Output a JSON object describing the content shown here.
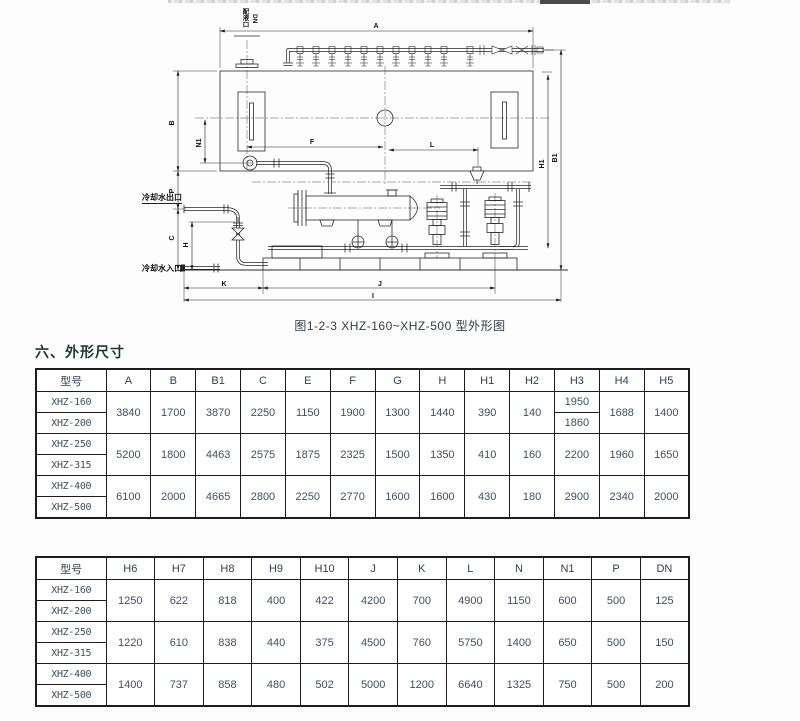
{
  "colors": {
    "line": "#2a2a2a",
    "table_text": "#3b5162",
    "heading_text": "#1f3038"
  },
  "drawing": {
    "caption": "图1-2-3 XHZ-160~XHZ-500 型外形图",
    "labels": {
      "a": "A",
      "b": "B",
      "n1": "N1",
      "f": "F",
      "l": "L",
      "p": "P",
      "c": "C",
      "h": "H",
      "h1": "H1",
      "b1": "B1",
      "k": "K",
      "j": "J",
      "i": "I",
      "port": "配液口",
      "dn": "DN",
      "water_outlet": "冷却水出口",
      "water_inlet": "冷却水入口"
    }
  },
  "section": {
    "heading": "六、外形尺寸"
  },
  "tables": [
    {
      "headers": [
        "型号",
        "A",
        "B",
        "B1",
        "C",
        "E",
        "F",
        "G",
        "H",
        "H1",
        "H2",
        "H3",
        "H4",
        "H5"
      ],
      "rows": [
        [
          {
            "t": "XHZ-160"
          },
          {
            "t": "3840",
            "rs": 2
          },
          {
            "t": "1700",
            "rs": 2
          },
          {
            "t": "3870",
            "rs": 2
          },
          {
            "t": "2250",
            "rs": 2
          },
          {
            "t": "1150",
            "rs": 2
          },
          {
            "t": "1900",
            "rs": 2
          },
          {
            "t": "1300",
            "rs": 2
          },
          {
            "t": "1440",
            "rs": 2
          },
          {
            "t": "390",
            "rs": 2
          },
          {
            "t": "140",
            "rs": 2
          },
          {
            "t": "1950"
          },
          {
            "t": "1688",
            "rs": 2
          },
          {
            "t": "1400",
            "rs": 2
          }
        ],
        [
          {
            "t": "XHZ-200"
          },
          {
            "t": "1860"
          }
        ],
        [
          {
            "t": "XHZ-250"
          },
          {
            "t": "5200",
            "rs": 2
          },
          {
            "t": "1800",
            "rs": 2
          },
          {
            "t": "4463",
            "rs": 2
          },
          {
            "t": "2575",
            "rs": 2
          },
          {
            "t": "1875",
            "rs": 2
          },
          {
            "t": "2325",
            "rs": 2
          },
          {
            "t": "1500",
            "rs": 2
          },
          {
            "t": "1350",
            "rs": 2
          },
          {
            "t": "410",
            "rs": 2
          },
          {
            "t": "160",
            "rs": 2
          },
          {
            "t": "2200",
            "rs": 2
          },
          {
            "t": "1960",
            "rs": 2
          },
          {
            "t": "1650",
            "rs": 2
          }
        ],
        [
          {
            "t": "XHZ-315"
          }
        ],
        [
          {
            "t": "XHZ-400"
          },
          {
            "t": "6100",
            "rs": 2
          },
          {
            "t": "2000",
            "rs": 2
          },
          {
            "t": "4665",
            "rs": 2
          },
          {
            "t": "2800",
            "rs": 2
          },
          {
            "t": "2250",
            "rs": 2
          },
          {
            "t": "2770",
            "rs": 2
          },
          {
            "t": "1600",
            "rs": 2
          },
          {
            "t": "1600",
            "rs": 2
          },
          {
            "t": "430",
            "rs": 2
          },
          {
            "t": "180",
            "rs": 2
          },
          {
            "t": "2900",
            "rs": 2
          },
          {
            "t": "2340",
            "rs": 2
          },
          {
            "t": "2000",
            "rs": 2
          }
        ],
        [
          {
            "t": "XHZ-500"
          }
        ]
      ]
    },
    {
      "headers": [
        "型号",
        "H6",
        "H7",
        "H8",
        "H9",
        "H10",
        "J",
        "K",
        "L",
        "N",
        "N1",
        "P",
        "DN"
      ],
      "rows": [
        [
          {
            "t": "XHZ-160"
          },
          {
            "t": "1250",
            "rs": 2
          },
          {
            "t": "622",
            "rs": 2
          },
          {
            "t": "818",
            "rs": 2
          },
          {
            "t": "400",
            "rs": 2
          },
          {
            "t": "422",
            "rs": 2
          },
          {
            "t": "4200",
            "rs": 2
          },
          {
            "t": "700",
            "rs": 2
          },
          {
            "t": "4900",
            "rs": 2
          },
          {
            "t": "1150",
            "rs": 2
          },
          {
            "t": "600",
            "rs": 2
          },
          {
            "t": "500",
            "rs": 2
          },
          {
            "t": "125",
            "rs": 2
          }
        ],
        [
          {
            "t": "XHZ-200"
          }
        ],
        [
          {
            "t": "XHZ-250"
          },
          {
            "t": "1220",
            "rs": 2
          },
          {
            "t": "610",
            "rs": 2
          },
          {
            "t": "838",
            "rs": 2
          },
          {
            "t": "440",
            "rs": 2
          },
          {
            "t": "375",
            "rs": 2
          },
          {
            "t": "4500",
            "rs": 2
          },
          {
            "t": "760",
            "rs": 2
          },
          {
            "t": "5750",
            "rs": 2
          },
          {
            "t": "1400",
            "rs": 2
          },
          {
            "t": "650",
            "rs": 2
          },
          {
            "t": "500",
            "rs": 2
          },
          {
            "t": "150",
            "rs": 2
          }
        ],
        [
          {
            "t": "XHZ-315"
          }
        ],
        [
          {
            "t": "XHZ-400"
          },
          {
            "t": "1400",
            "rs": 2
          },
          {
            "t": "737",
            "rs": 2
          },
          {
            "t": "858",
            "rs": 2
          },
          {
            "t": "480",
            "rs": 2
          },
          {
            "t": "502",
            "rs": 2
          },
          {
            "t": "5000",
            "rs": 2
          },
          {
            "t": "1200",
            "rs": 2
          },
          {
            "t": "6640",
            "rs": 2
          },
          {
            "t": "1325",
            "rs": 2
          },
          {
            "t": "750",
            "rs": 2
          },
          {
            "t": "500",
            "rs": 2
          },
          {
            "t": "200",
            "rs": 2
          }
        ],
        [
          {
            "t": "XHZ-500"
          }
        ]
      ]
    }
  ]
}
